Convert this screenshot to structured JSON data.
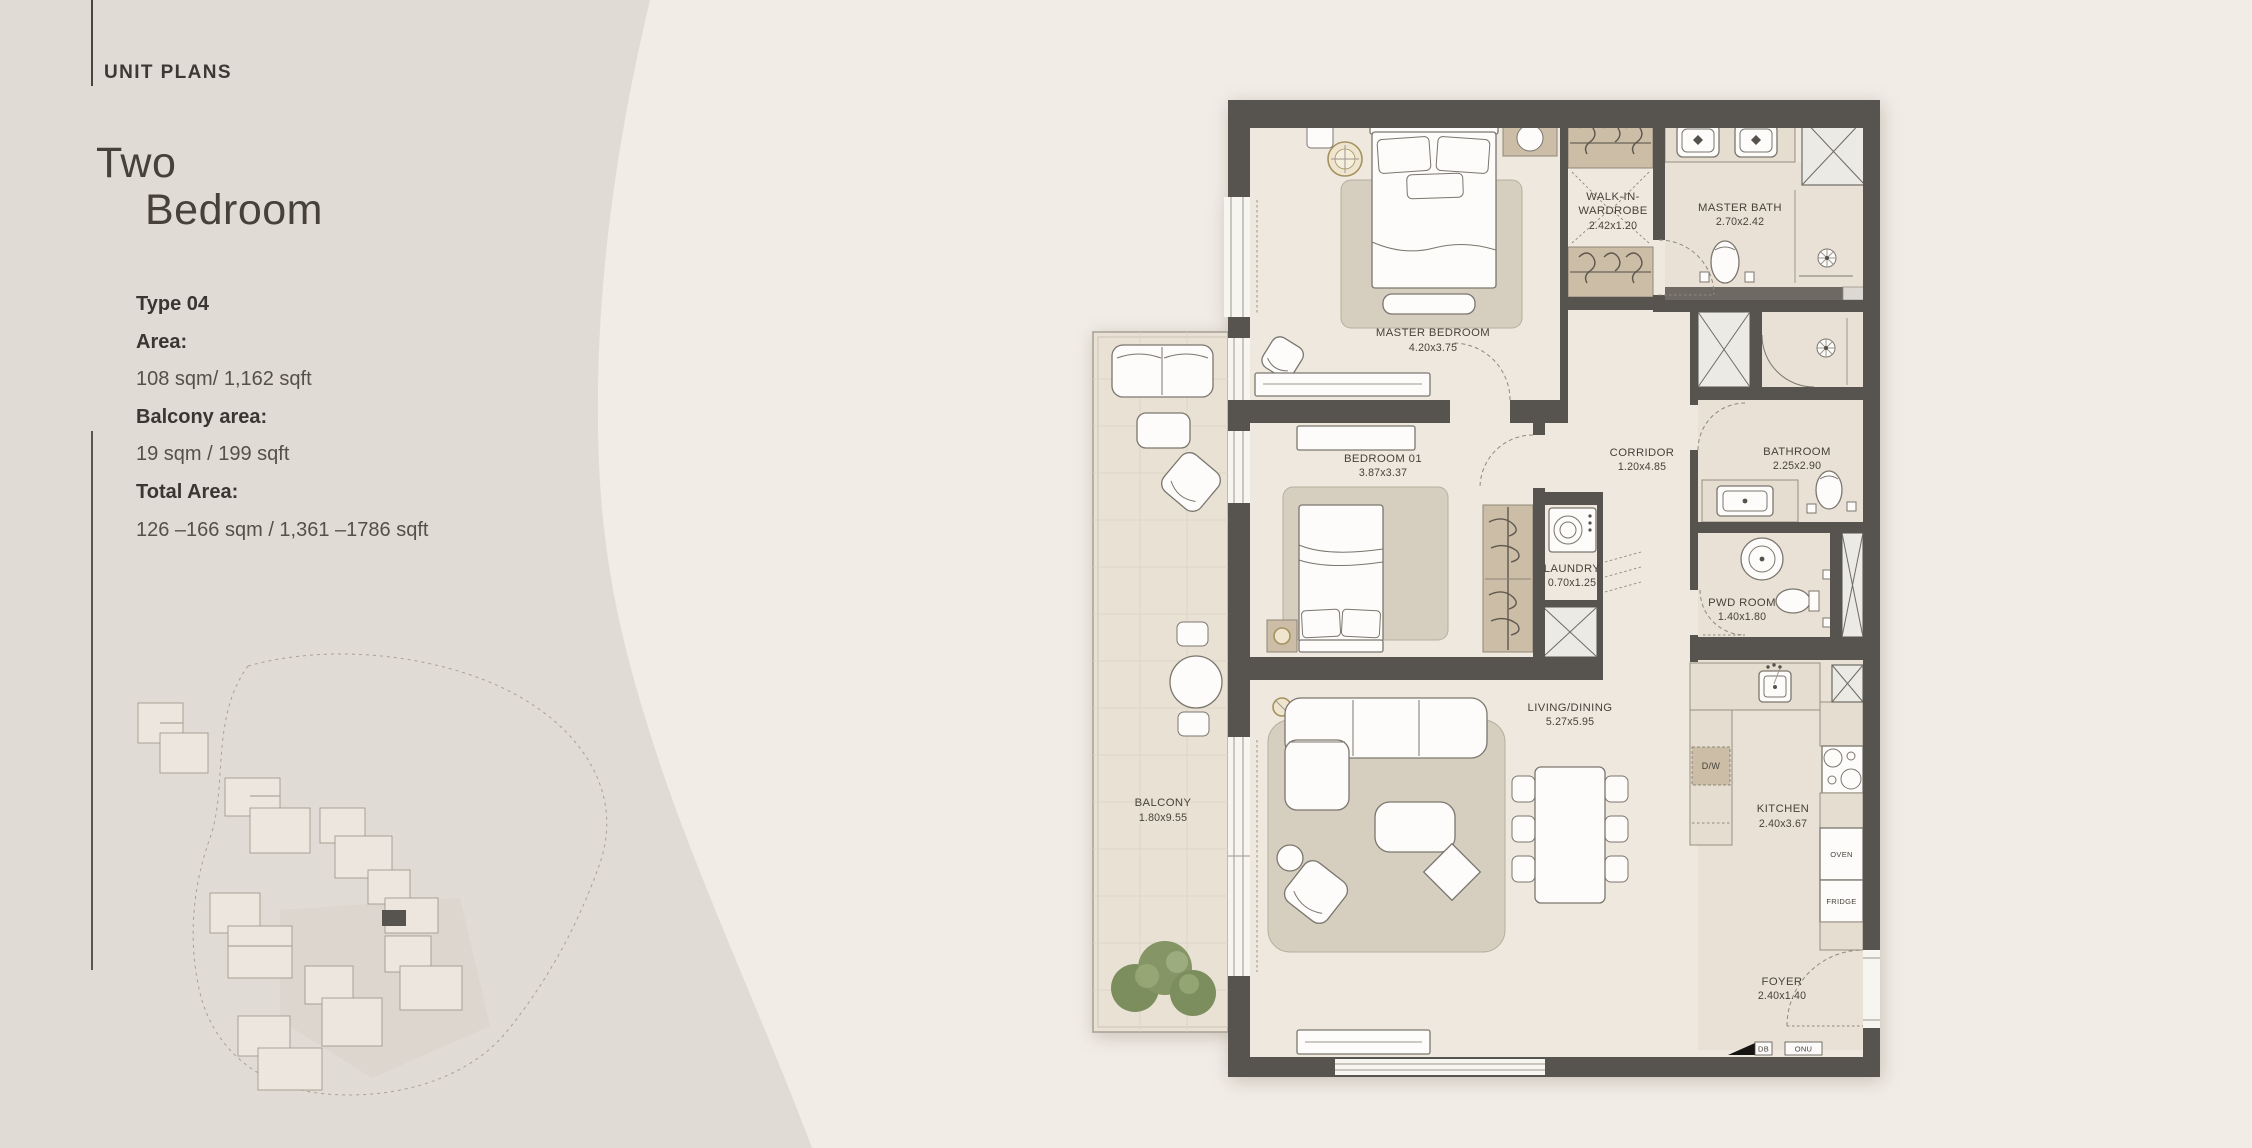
{
  "header": {
    "section_label": "UNIT PLANS"
  },
  "title": {
    "line1": "Two",
    "line2": "Bedroom"
  },
  "specs": {
    "type": "Type 04",
    "area_label": "Area:",
    "area_value": "108 sqm/ 1,162 sqft",
    "balcony_label": "Balcony area:",
    "balcony_value": "19 sqm / 199 sqft",
    "total_label": "Total Area:",
    "total_value": "126 –166 sqm / 1,361 –1786 sqft"
  },
  "floor_plan": {
    "rooms": {
      "master_bedroom": {
        "name": "MASTER BEDROOM",
        "dims": "4.20x3.75"
      },
      "walk_in_wardrobe": {
        "line1": "WALK-IN-",
        "line2": "WARDROBE",
        "dims": "2.42x1.20"
      },
      "master_bath": {
        "name": "MASTER BATH",
        "dims": "2.70x2.42"
      },
      "bedroom_01": {
        "name": "BEDROOM 01",
        "dims": "3.87x3.37"
      },
      "corridor": {
        "name": "CORRIDOR",
        "dims": "1.20x4.85"
      },
      "bathroom": {
        "name": "BATHROOM",
        "dims": "2.25x2.90"
      },
      "laundry": {
        "name": "LAUNDRY",
        "dims": "0.70x1.25"
      },
      "pwd_room": {
        "name": "PWD ROOM",
        "dims": "1.40x1.80"
      },
      "living_dining": {
        "name": "LIVING/DINING",
        "dims": "5.27x5.95"
      },
      "kitchen": {
        "name": "KITCHEN",
        "dims": "2.40x3.67"
      },
      "foyer": {
        "name": "FOYER",
        "dims": "2.40x1.40"
      },
      "balcony": {
        "name": "BALCONY",
        "dims": "1.80x9.55"
      }
    },
    "appliances": {
      "dishwasher": "D/W",
      "oven": "OVEN",
      "fridge": "FRIDGE"
    },
    "utilities": {
      "db": "DB",
      "onu": "ONU"
    }
  },
  "colors": {
    "background_left": "#e0dbd4",
    "background_right": "#f1ece6",
    "wall": "#57534e",
    "floor": "#efe8de",
    "balcony_floor": "#e8e1d4",
    "rug": "#d6cfc0",
    "wood": "#cbbda6",
    "text_dark": "#3b3631",
    "plan_text": "#47423b",
    "accent_gold": "#a5925f",
    "plant_green": "#7c8e5e"
  }
}
